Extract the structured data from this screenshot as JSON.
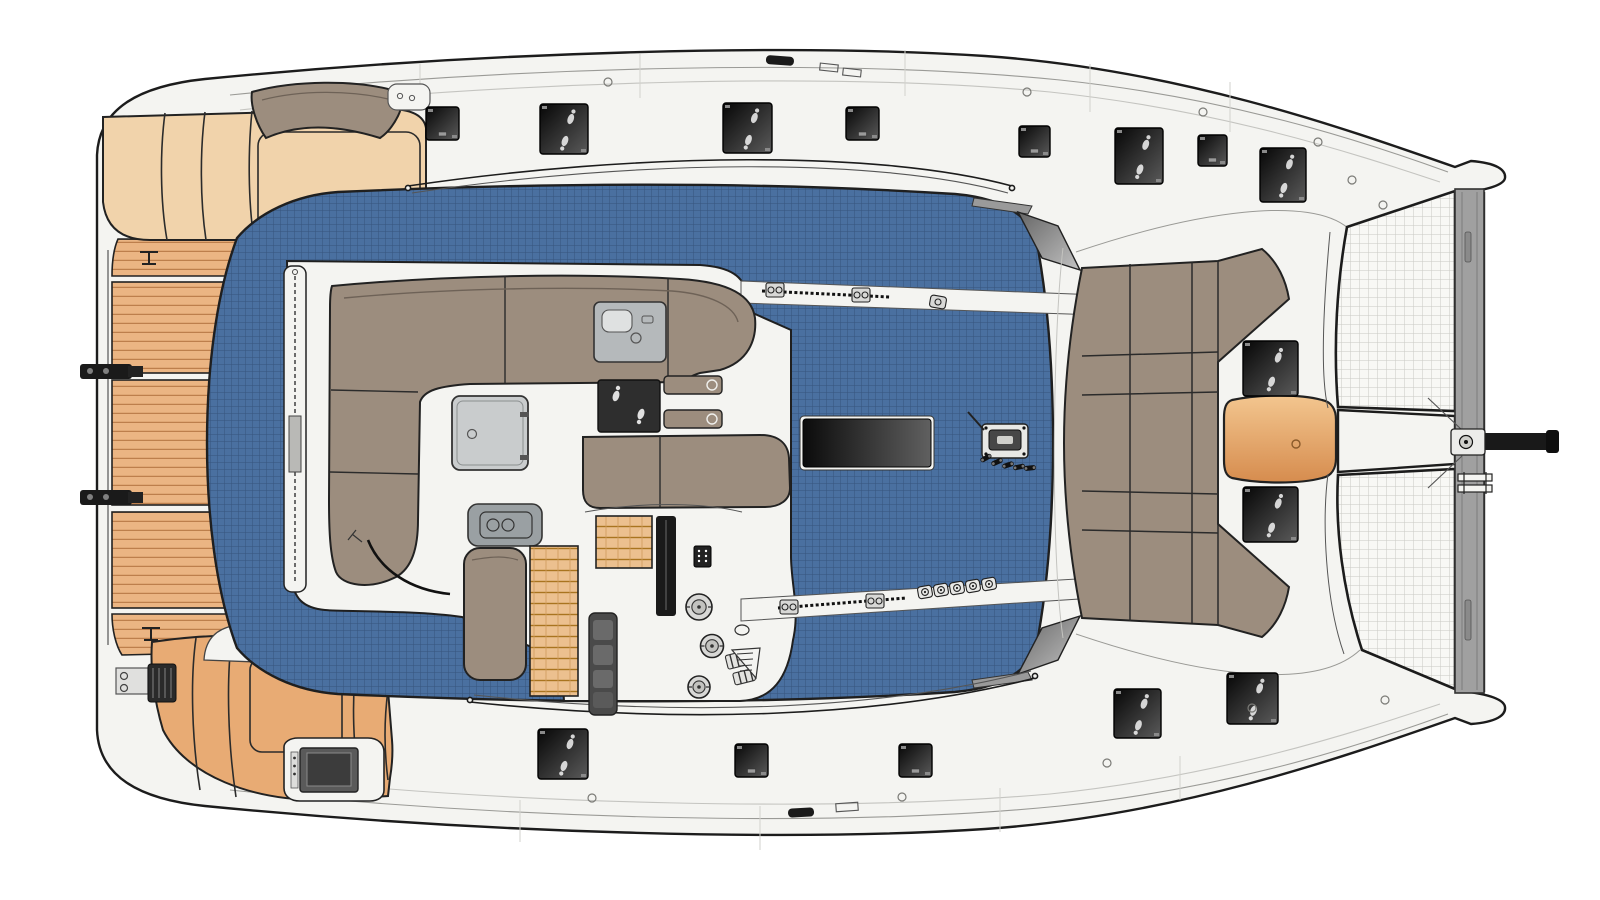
{
  "meta": {
    "title": "Catamaran sailboat deck plan - overhead top view",
    "image_type": "technical deck-plan illustration",
    "visible_text": ""
  },
  "palette": {
    "background": "#ffffff",
    "hull_white": "#f4f4f1",
    "outline_dark": "#1c1c1c",
    "sheer_line": "#9a9a96",
    "nonskid_blue": "#4a70a0",
    "nonskid_grid": "#2f4f78",
    "cushion_taupe": "#9c8d7e",
    "pad_cream": "#f1d3ab",
    "pad_tan": "#e8ab74",
    "teak_wood": "#ebb583",
    "teak_line": "#bd7f4c",
    "trampoline_mesh": "#f8f8f5",
    "mesh_line": "#c9c9c3",
    "beam_gray": "#a0a0a0",
    "hatch_dark": "#060606",
    "hatch_light": "#5a5a5a",
    "console_gray": "#b5b9bb",
    "table_orange_top": "#f3c68f",
    "table_orange_bottom": "#d68c4e",
    "winch_steel": "#d8d8d6"
  },
  "deck_fittings": {
    "hatches_large": [
      [
        540,
        104,
        48,
        50
      ],
      [
        723,
        103,
        49,
        50
      ],
      [
        1115,
        128,
        48,
        56
      ],
      [
        1260,
        148,
        46,
        54
      ],
      [
        538,
        729,
        50,
        50
      ],
      [
        1114,
        689,
        47,
        49
      ],
      [
        1227,
        673,
        51,
        51
      ],
      [
        1243,
        341,
        55,
        55
      ],
      [
        1243,
        487,
        55,
        55
      ]
    ],
    "hatches_small": [
      [
        426,
        107,
        33,
        33
      ],
      [
        846,
        107,
        33,
        33
      ],
      [
        1019,
        126,
        31,
        31
      ],
      [
        1198,
        135,
        29,
        31
      ],
      [
        735,
        744,
        33,
        33
      ],
      [
        899,
        744,
        33,
        33
      ]
    ],
    "bolt_circles": [
      [
        608,
        82
      ],
      [
        1027,
        92
      ],
      [
        1203,
        112
      ],
      [
        1318,
        142
      ],
      [
        1352,
        180
      ],
      [
        1383,
        205
      ],
      [
        592,
        798
      ],
      [
        902,
        797
      ],
      [
        1107,
        763
      ],
      [
        1252,
        708
      ],
      [
        1385,
        700
      ]
    ],
    "deck_organizers": [
      [
        925,
        592
      ],
      [
        941,
        590
      ],
      [
        957,
        588
      ],
      [
        973,
        586
      ],
      [
        989,
        584
      ]
    ],
    "halyard_cleats": [
      [
        986,
        458
      ],
      [
        997,
        462
      ],
      [
        1008,
        465
      ],
      [
        1019,
        467
      ],
      [
        1030,
        468
      ]
    ]
  },
  "winches": [
    [
      699,
      607,
      13
    ],
    [
      712,
      646,
      11.5
    ],
    [
      699,
      687,
      11
    ]
  ],
  "parts": {
    "swim_platform": "teak swim platform with dinghy davits",
    "aft_sunpads": "two tan aft sunpad groups",
    "lounge": "L-shaped taupe cockpit sofa with square table",
    "helm": "helm pod with keypad, three winches and rope clutches",
    "coachroof": "blue non-skid coachroof with saloon skylight and mast step",
    "forward_cockpit": "taupe forward cockpit seating with orange table",
    "bow": "twin trampolines, forward crossbeam and black bowsprit"
  }
}
